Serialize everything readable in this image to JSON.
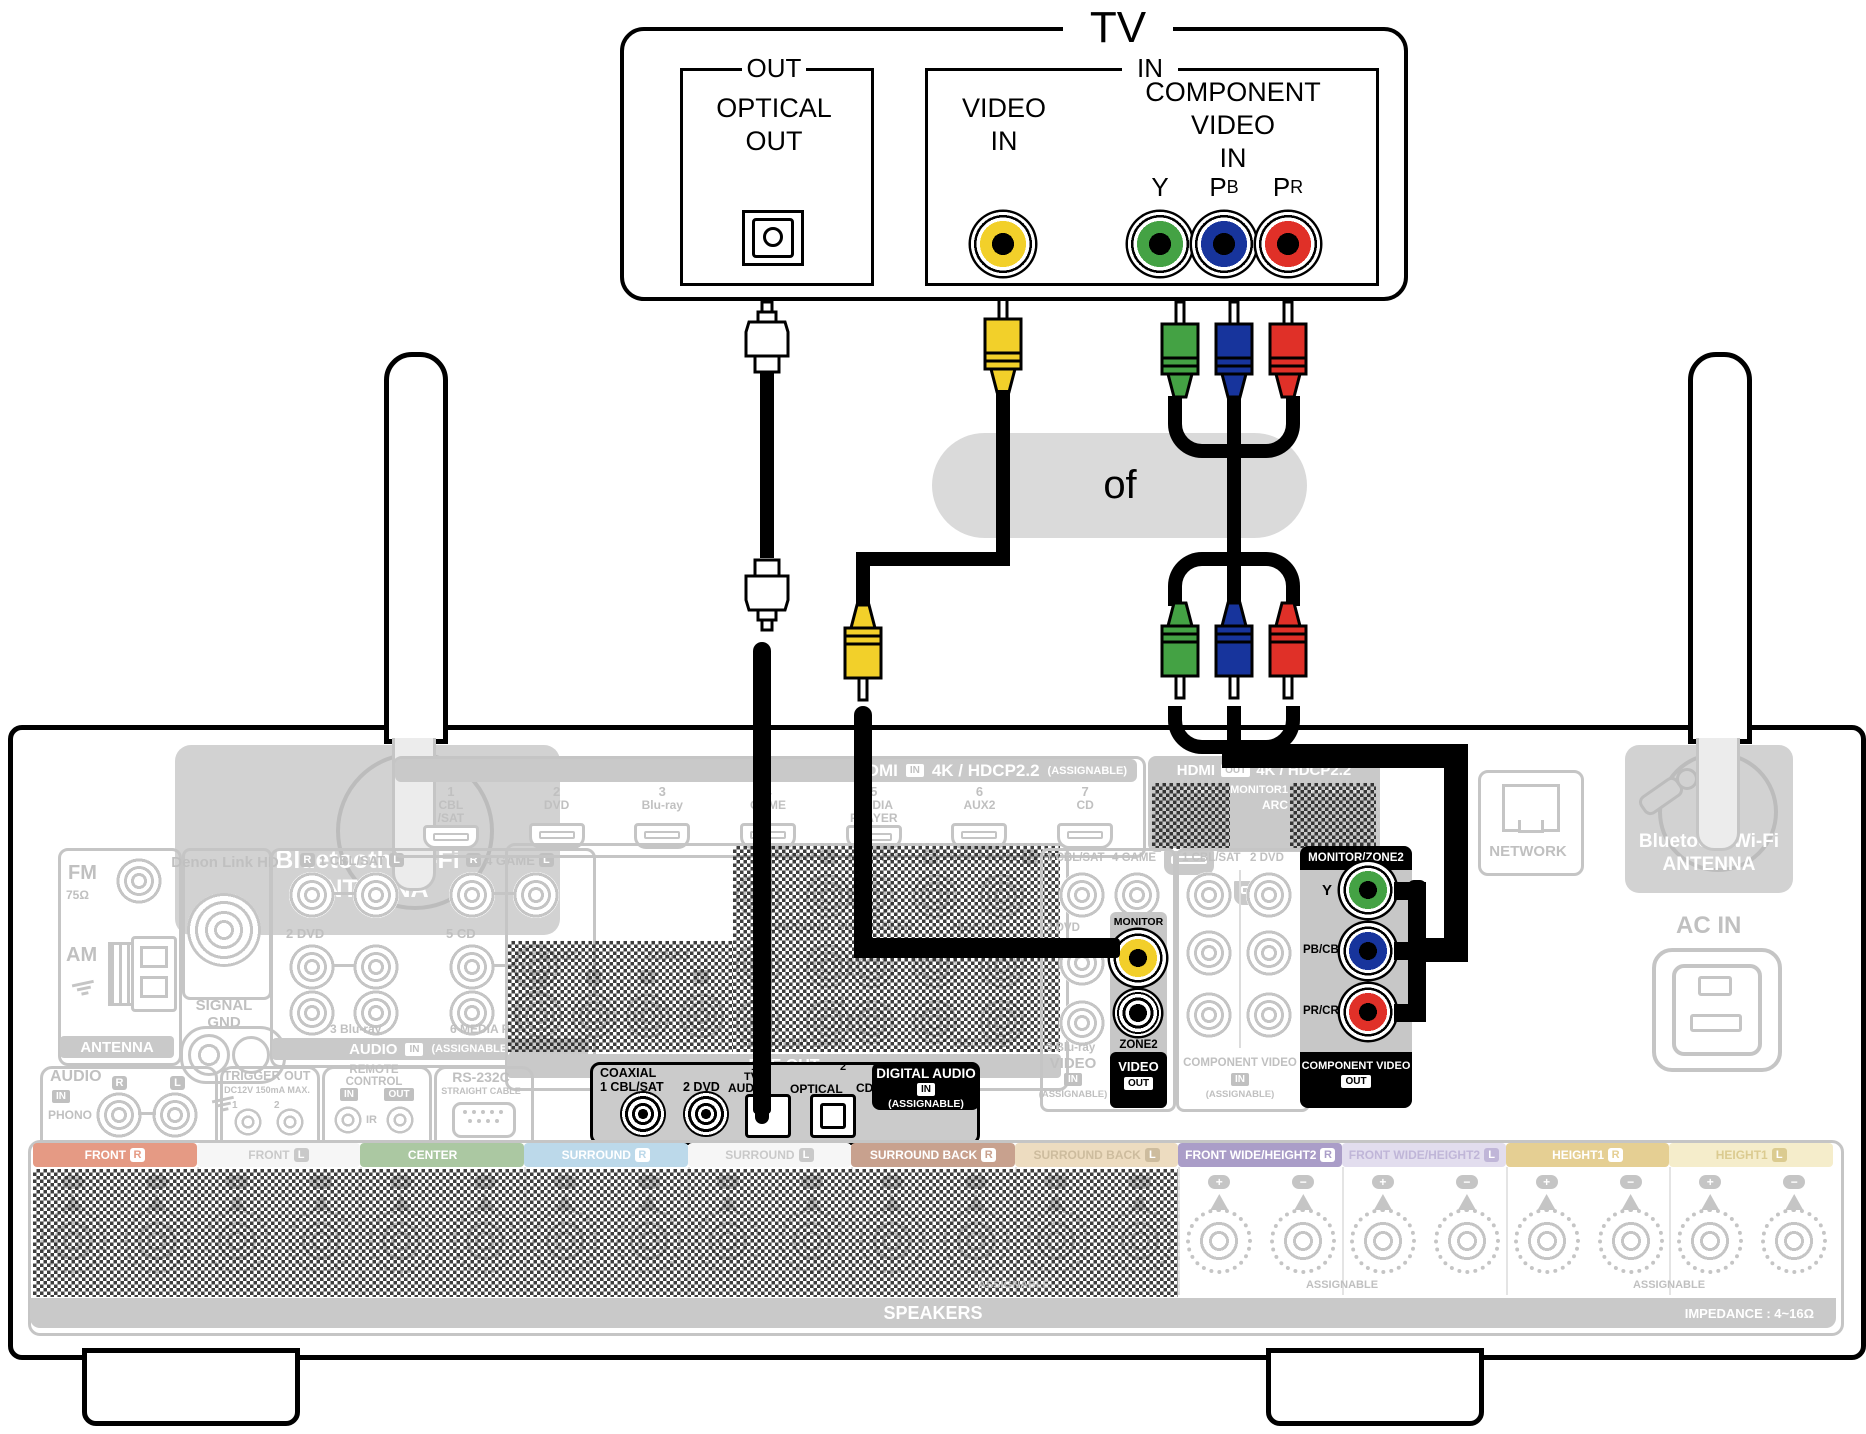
{
  "tv": {
    "title": "TV",
    "out_group": "OUT",
    "optical_line1": "OPTICAL",
    "optical_line2": "OUT",
    "in_group": "IN",
    "video_line1": "VIDEO",
    "video_line2": "IN",
    "component_line1": "COMPONENT VIDEO",
    "component_line2": "IN",
    "video_jack_color": "#f2d02a",
    "channels": [
      {
        "p": "Y",
        "s": "",
        "color": "#44a244"
      },
      {
        "p": "P",
        "s": "B",
        "color": "#17349c"
      },
      {
        "p": "P",
        "s": "R",
        "color": "#e03028"
      }
    ]
  },
  "link": {
    "or_label": "of"
  },
  "receiver": {
    "badges": {
      "r": "R",
      "l": "L"
    },
    "bt_left": {
      "line1": "Bluetooth/Wi-Fi",
      "line2": "ANTENNA"
    },
    "bt_right": {
      "line1": "Bluetooth/Wi-Fi",
      "line2": "ANTENNA"
    },
    "tuner": {
      "fm": "FM",
      "ohm": "75Ω",
      "am": "AM",
      "bar": "ANTENNA"
    },
    "denon": {
      "title": "Denon Link HD",
      "signal1": "SIGNAL",
      "signal2": "GND"
    },
    "audio_in": {
      "r1a": "1 CBL/SAT",
      "r1b": "4 GAME",
      "r2a": "2 DVD",
      "r2b": "5 CD",
      "r3a": "3 Blu-ray",
      "r3b": "6 MEDIA PLAYER",
      "name": "AUDIO",
      "badge": "IN",
      "note": "(ASSIGNABLE)"
    },
    "hdmi_in": {
      "name": "HDMI",
      "badge": "IN",
      "spec": "4K / HDCP2.2",
      "note": "(ASSIGNABLE)",
      "ports": [
        {
          "n": "1",
          "l1": "CBL",
          "l2": "/SAT"
        },
        {
          "n": "2",
          "l1": "DVD",
          "l2": ""
        },
        {
          "n": "3",
          "l1": "Blu-ray",
          "l2": ""
        },
        {
          "n": "4",
          "l1": "GAME",
          "l2": ""
        },
        {
          "n": "5",
          "l1": "MEDIA",
          "l2": "PLAYER"
        },
        {
          "n": "6",
          "l1": "AUX2",
          "l2": ""
        },
        {
          "n": "7",
          "l1": "CD",
          "l2": ""
        }
      ]
    },
    "hdmi_out": {
      "name": "HDMI",
      "badge": "OUT",
      "spec": "4K / HDCP2.2",
      "zone2": "ZONE2",
      "monitor1": "MONITOR1",
      "arc": "ARC",
      "monitor2": "MONITOR2"
    },
    "network": {
      "label": "NETWORK"
    },
    "pre_out": {
      "front": "FRONT",
      "center": "CENTER",
      "front_wide": "FRONT WIDE",
      "surround": "SURROUND",
      "subwoofer": "SUBWOOFER",
      "height1": "HEIGHT1",
      "surround_back": "SURROUND BACK",
      "height2": "HEIGHT2",
      "two": "2",
      "zone2": "ZONE2",
      "zone3": "ZONE3",
      "bar": "PRE OUT"
    },
    "digital": {
      "coaxial": "COAXIAL",
      "c1": "1 CBL/SAT",
      "c2": "2 DVD",
      "n1": "1",
      "tv": "TV",
      "audio": "AUDIO",
      "optical": "OPTICAL",
      "cd": "CD",
      "n2": "2",
      "title": "DIGITAL AUDIO",
      "badge": "IN",
      "note": "(ASSIGNABLE)"
    },
    "video_in": {
      "c1": "1 CBL/SAT",
      "c2": "4 GAME",
      "r2": "2 DVD",
      "r3": "3 Blu-ray",
      "name": "VIDEO",
      "badge": "IN",
      "note": "(ASSIGNABLE)"
    },
    "video_out": {
      "monitor": "MONITOR",
      "zone2": "ZONE2",
      "name": "VIDEO",
      "badge": "OUT",
      "jack_color": "#f2cf2b"
    },
    "comp_in": {
      "c1": "1 CBL/SAT",
      "c2": "2 DVD",
      "name": "COMPONENT VIDEO",
      "badge": "IN",
      "note": "(ASSIGNABLE)"
    },
    "comp_out": {
      "header": "MONITOR/ZONE2",
      "name": "COMPONENT VIDEO",
      "badge": "OUT",
      "channels": [
        {
          "label": "Y",
          "color": "#44a244"
        },
        {
          "label": "PB/CB",
          "color": "#17349c"
        },
        {
          "label": "PR/CR",
          "color": "#e03028"
        }
      ]
    },
    "phono": {
      "name": "AUDIO",
      "badge": "IN",
      "phono": "PHONO"
    },
    "trigger": {
      "title": "TRIGGER OUT",
      "sub": "DC12V 150mA MAX.",
      "j1": "1",
      "j2": "2"
    },
    "remote": {
      "title": "REMOTE CONTROL",
      "in": "IN",
      "out": "OUT",
      "ir": "IR"
    },
    "rs232": {
      "title": "RS-232C",
      "sub": "STRAIGHT CABLE"
    },
    "ac_in": "AC IN",
    "speakers": {
      "plus": "+",
      "minus": "−",
      "assignable": "ASSIGNABLE",
      "bar": "SPEAKERS",
      "impedance": "IMPEDANCE : 4~16Ω",
      "columns": [
        {
          "name": "FRONT",
          "side": "R",
          "bg": "#e59a84",
          "fg": "#ffffff",
          "bbg": "#ffffff",
          "bfg": "#e59a84"
        },
        {
          "name": "FRONT",
          "side": "L",
          "bg": "#f6f6f6",
          "fg": "#c9c9c9",
          "bbg": "#c9c9c9",
          "bfg": "#ffffff"
        },
        {
          "name": "CENTER",
          "side": "",
          "bg": "#abc8a2",
          "fg": "#ffffff",
          "bbg": "#abc8a2",
          "bfg": "#abc8a2"
        },
        {
          "name": "SURROUND",
          "side": "R",
          "bg": "#bcd9ea",
          "fg": "#ffffff",
          "bbg": "#ffffff",
          "bfg": "#bcd9ea"
        },
        {
          "name": "SURROUND",
          "side": "L",
          "bg": "#f6f6f6",
          "fg": "#c9c9c9",
          "bbg": "#c9c9c9",
          "bfg": "#ffffff"
        },
        {
          "name": "SURROUND BACK",
          "side": "R",
          "bg": "#c8a18e",
          "fg": "#ffffff",
          "bbg": "#ffffff",
          "bfg": "#c8a18e"
        },
        {
          "name": "SURROUND BACK",
          "side": "L",
          "bg": "#eddcc0",
          "fg": "#cdbc9e",
          "bbg": "#cdbc9e",
          "bfg": "#ffffff"
        },
        {
          "name": "FRONT WIDE/HEIGHT2",
          "side": "R",
          "bg": "#aa9dc8",
          "fg": "#ffffff",
          "bbg": "#ffffff",
          "bfg": "#aa9dc8"
        },
        {
          "name": "FRONT WIDE/HEIGHT2",
          "side": "L",
          "bg": "#e2ddee",
          "fg": "#c0b6d8",
          "bbg": "#c0b6d8",
          "bfg": "#ffffff"
        },
        {
          "name": "HEIGHT1",
          "side": "R",
          "bg": "#e5cf93",
          "fg": "#ffffff",
          "bbg": "#ffffff",
          "bfg": "#e5cf93"
        },
        {
          "name": "HEIGHT1",
          "side": "L",
          "bg": "#f5edcb",
          "fg": "#dbcb90",
          "bbg": "#dbcb90",
          "bfg": "#ffffff"
        }
      ]
    }
  }
}
